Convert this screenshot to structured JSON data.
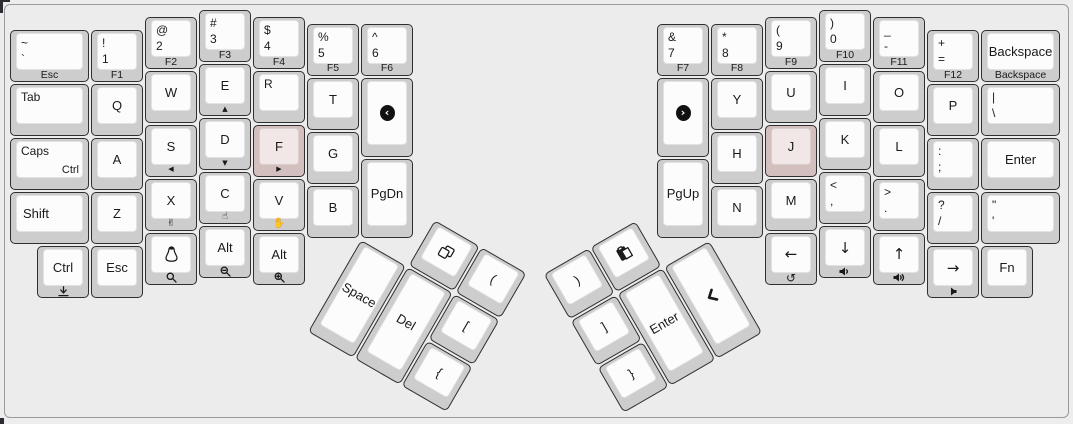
{
  "colors": {
    "page": "#ededed",
    "frame_border": "#9a9a9a",
    "frame_bg": "#ececec",
    "key_side": "#cdcdcd",
    "key_top": "#fcfcfc",
    "key_outline": "#2f2f2f",
    "homing_side": "#d4bfbf",
    "homing_top": "#f2e7e7",
    "legend": "#1a1a1a"
  },
  "keyboard": {
    "unit": 54,
    "clusters": {
      "left": {
        "x": 361,
        "y": 239.5,
        "r": 30
      },
      "right": {
        "x": 711,
        "y": 239.5,
        "r": -30
      }
    },
    "keys": [
      {
        "n": "grave",
        "x": 10,
        "y": 30.25,
        "w": 81,
        "tl": [
          "~",
          "`"
        ],
        "front": "Esc"
      },
      {
        "n": "1",
        "x": 91,
        "y": 30.25,
        "tl": [
          "!",
          "1"
        ],
        "front": "F1"
      },
      {
        "n": "2",
        "x": 145,
        "y": 16.75,
        "tl": [
          "@",
          "2"
        ],
        "front": "F2"
      },
      {
        "n": "3",
        "x": 199,
        "y": 10,
        "tl": [
          "#",
          "3"
        ],
        "front": "F3"
      },
      {
        "n": "4",
        "x": 253,
        "y": 16.75,
        "tl": [
          "$",
          "4"
        ],
        "front": "F4"
      },
      {
        "n": "5",
        "x": 307,
        "y": 23.5,
        "tl": [
          "%",
          "5"
        ],
        "front": "F5"
      },
      {
        "n": "6",
        "x": 361,
        "y": 23.5,
        "tl": [
          "^",
          "6"
        ],
        "front": "F6"
      },
      {
        "n": "tab",
        "x": 10,
        "y": 84.25,
        "w": 81,
        "tl": [
          "Tab"
        ]
      },
      {
        "n": "q",
        "x": 91,
        "y": 84.25,
        "c": "Q"
      },
      {
        "n": "w",
        "x": 145,
        "y": 70.75,
        "c": "W"
      },
      {
        "n": "e",
        "x": 199,
        "y": 64,
        "c": "E",
        "fi": "tri-up"
      },
      {
        "n": "r",
        "x": 253,
        "y": 70.75,
        "tl": [
          "R"
        ]
      },
      {
        "n": "t",
        "x": 307,
        "y": 77.5,
        "c": "T"
      },
      {
        "n": "media-prev",
        "x": 361,
        "y": 77.5,
        "h": 81,
        "ci": "chev-circle-left"
      },
      {
        "n": "caps",
        "x": 10,
        "y": 138.25,
        "w": 81,
        "tl": [
          "Caps"
        ],
        "br": "Ctrl"
      },
      {
        "n": "a",
        "x": 91,
        "y": 138.25,
        "c": "A"
      },
      {
        "n": "s",
        "x": 145,
        "y": 124.75,
        "c": "S",
        "fi": "tri-left"
      },
      {
        "n": "d",
        "x": 199,
        "y": 118,
        "c": "D",
        "fi": "tri-down"
      },
      {
        "n": "f",
        "x": 253,
        "y": 124.75,
        "c": "F",
        "fi": "tri-right",
        "color": "pink"
      },
      {
        "n": "g",
        "x": 307,
        "y": 131.5,
        "c": "G"
      },
      {
        "n": "shift-left",
        "x": 10,
        "y": 192.25,
        "w": 81,
        "c": "Shift",
        "align": "left"
      },
      {
        "n": "z",
        "x": 91,
        "y": 192.25,
        "c": "Z"
      },
      {
        "n": "x",
        "x": 145,
        "y": 178.75,
        "c": "X",
        "fi": "hand-scissors"
      },
      {
        "n": "c",
        "x": 199,
        "y": 172,
        "c": "C",
        "fi": "hand-point"
      },
      {
        "n": "v",
        "x": 253,
        "y": 178.75,
        "c": "V",
        "fi": "hand-paper"
      },
      {
        "n": "b",
        "x": 307,
        "y": 185.5,
        "c": "B"
      },
      {
        "n": "pgdn",
        "x": 361,
        "y": 158.5,
        "h": 81,
        "c": "PgDn"
      },
      {
        "n": "ctrl-left",
        "x": 37,
        "y": 246.25,
        "c": "Ctrl",
        "fi": "download"
      },
      {
        "n": "esc-left",
        "x": 91,
        "y": 246.25,
        "c": "Esc"
      },
      {
        "n": "linux",
        "x": 145,
        "y": 232.75,
        "ci": "penguin",
        "fi": "loupe"
      },
      {
        "n": "alt-1",
        "x": 199,
        "y": 226,
        "c": "Alt",
        "fi": "loupe-minus"
      },
      {
        "n": "alt-2",
        "x": 253,
        "y": 232.75,
        "c": "Alt",
        "fi": "loupe-plus"
      },
      {
        "n": "copy",
        "cluster": "left",
        "x": 54,
        "y": -54,
        "ci": "copy"
      },
      {
        "n": "paren-open",
        "cluster": "left",
        "x": 108,
        "y": -54,
        "c": "("
      },
      {
        "n": "space",
        "cluster": "left",
        "x": 0,
        "y": 0,
        "h": 108,
        "c": "Space"
      },
      {
        "n": "del",
        "cluster": "left",
        "x": 54,
        "y": 0,
        "h": 108,
        "c": "Del"
      },
      {
        "n": "bracket-open",
        "cluster": "left",
        "x": 108,
        "y": 0,
        "c": "["
      },
      {
        "n": "brace-open",
        "cluster": "left",
        "x": 108,
        "y": 54,
        "c": "{"
      },
      {
        "n": "7",
        "x": 657,
        "y": 23.5,
        "tl": [
          "&",
          "7"
        ],
        "front": "F7"
      },
      {
        "n": "8",
        "x": 711,
        "y": 23.5,
        "tl": [
          "*",
          "8"
        ],
        "front": "F8"
      },
      {
        "n": "9",
        "x": 765,
        "y": 16.75,
        "tl": [
          "(",
          "9"
        ],
        "front": "F9"
      },
      {
        "n": "0",
        "x": 819,
        "y": 10,
        "tl": [
          ")",
          "0"
        ],
        "front": "F10"
      },
      {
        "n": "minus",
        "x": 873,
        "y": 16.75,
        "tl": [
          "_",
          "-"
        ],
        "front": "F11"
      },
      {
        "n": "equals",
        "x": 927,
        "y": 30.25,
        "tl": [
          "+",
          "="
        ],
        "front": "F12"
      },
      {
        "n": "backspace",
        "x": 981,
        "y": 30.25,
        "w": 81,
        "c": "Backspace",
        "front": "Backspace"
      },
      {
        "n": "media-next",
        "x": 657,
        "y": 77.5,
        "h": 81,
        "ci": "chev-circle-right"
      },
      {
        "n": "y",
        "x": 711,
        "y": 77.5,
        "c": "Y"
      },
      {
        "n": "u",
        "x": 765,
        "y": 70.75,
        "c": "U"
      },
      {
        "n": "i",
        "x": 819,
        "y": 64,
        "c": "I"
      },
      {
        "n": "o",
        "x": 873,
        "y": 70.75,
        "c": "O"
      },
      {
        "n": "p",
        "x": 927,
        "y": 84.25,
        "c": "P"
      },
      {
        "n": "backslash",
        "x": 981,
        "y": 84.25,
        "w": 81,
        "tl": [
          "|",
          "\\"
        ]
      },
      {
        "n": "h",
        "x": 711,
        "y": 131.5,
        "c": "H"
      },
      {
        "n": "j",
        "x": 765,
        "y": 124.75,
        "c": "J",
        "color": "pink"
      },
      {
        "n": "k",
        "x": 819,
        "y": 118,
        "c": "K"
      },
      {
        "n": "l",
        "x": 873,
        "y": 124.75,
        "c": "L"
      },
      {
        "n": "semicolon",
        "x": 927,
        "y": 138.25,
        "tl": [
          ":",
          ";"
        ]
      },
      {
        "n": "enter-main",
        "x": 981,
        "y": 138.25,
        "w": 81,
        "c": "Enter"
      },
      {
        "n": "pgup",
        "x": 657,
        "y": 158.5,
        "h": 81,
        "c": "PgUp"
      },
      {
        "n": "n",
        "x": 711,
        "y": 185.5,
        "c": "N"
      },
      {
        "n": "m",
        "x": 765,
        "y": 178.75,
        "c": "M"
      },
      {
        "n": "comma",
        "x": 819,
        "y": 172,
        "tl": [
          "<",
          ","
        ]
      },
      {
        "n": "period",
        "x": 873,
        "y": 178.75,
        "tl": [
          ">",
          "."
        ]
      },
      {
        "n": "slash",
        "x": 927,
        "y": 192.25,
        "tl": [
          "?",
          "/"
        ]
      },
      {
        "n": "quote",
        "x": 981,
        "y": 192.25,
        "w": 81,
        "tl": [
          "\"",
          "'"
        ]
      },
      {
        "n": "arrow-left",
        "x": 765,
        "y": 232.75,
        "c": "←",
        "arrow": true,
        "fi": "undo"
      },
      {
        "n": "arrow-down",
        "x": 819,
        "y": 226,
        "c": "↓",
        "arrow": true,
        "fi": "vol-down"
      },
      {
        "n": "arrow-up",
        "x": 873,
        "y": 232.75,
        "c": "↑",
        "arrow": true,
        "fi": "vol-up"
      },
      {
        "n": "arrow-right",
        "x": 927,
        "y": 246.25,
        "c": "→",
        "arrow": true,
        "fi": "vol-off"
      },
      {
        "n": "fn",
        "x": 981,
        "y": 246.25,
        "c": "Fn"
      },
      {
        "n": "paren-close",
        "cluster": "right",
        "x": -162,
        "y": -54,
        "c": ")"
      },
      {
        "n": "paste",
        "cluster": "right",
        "x": -108,
        "y": -54,
        "ci": "paste"
      },
      {
        "n": "bracket-close",
        "cluster": "right",
        "x": -162,
        "y": 0,
        "c": "]"
      },
      {
        "n": "enter-thumb",
        "cluster": "right",
        "x": -108,
        "y": 0,
        "h": 108,
        "c": "Enter"
      },
      {
        "n": "pointer",
        "cluster": "right",
        "x": -54,
        "y": 0,
        "h": 108,
        "ci": "pointer"
      },
      {
        "n": "brace-close",
        "cluster": "right",
        "x": -162,
        "y": 54,
        "c": "}"
      }
    ]
  }
}
